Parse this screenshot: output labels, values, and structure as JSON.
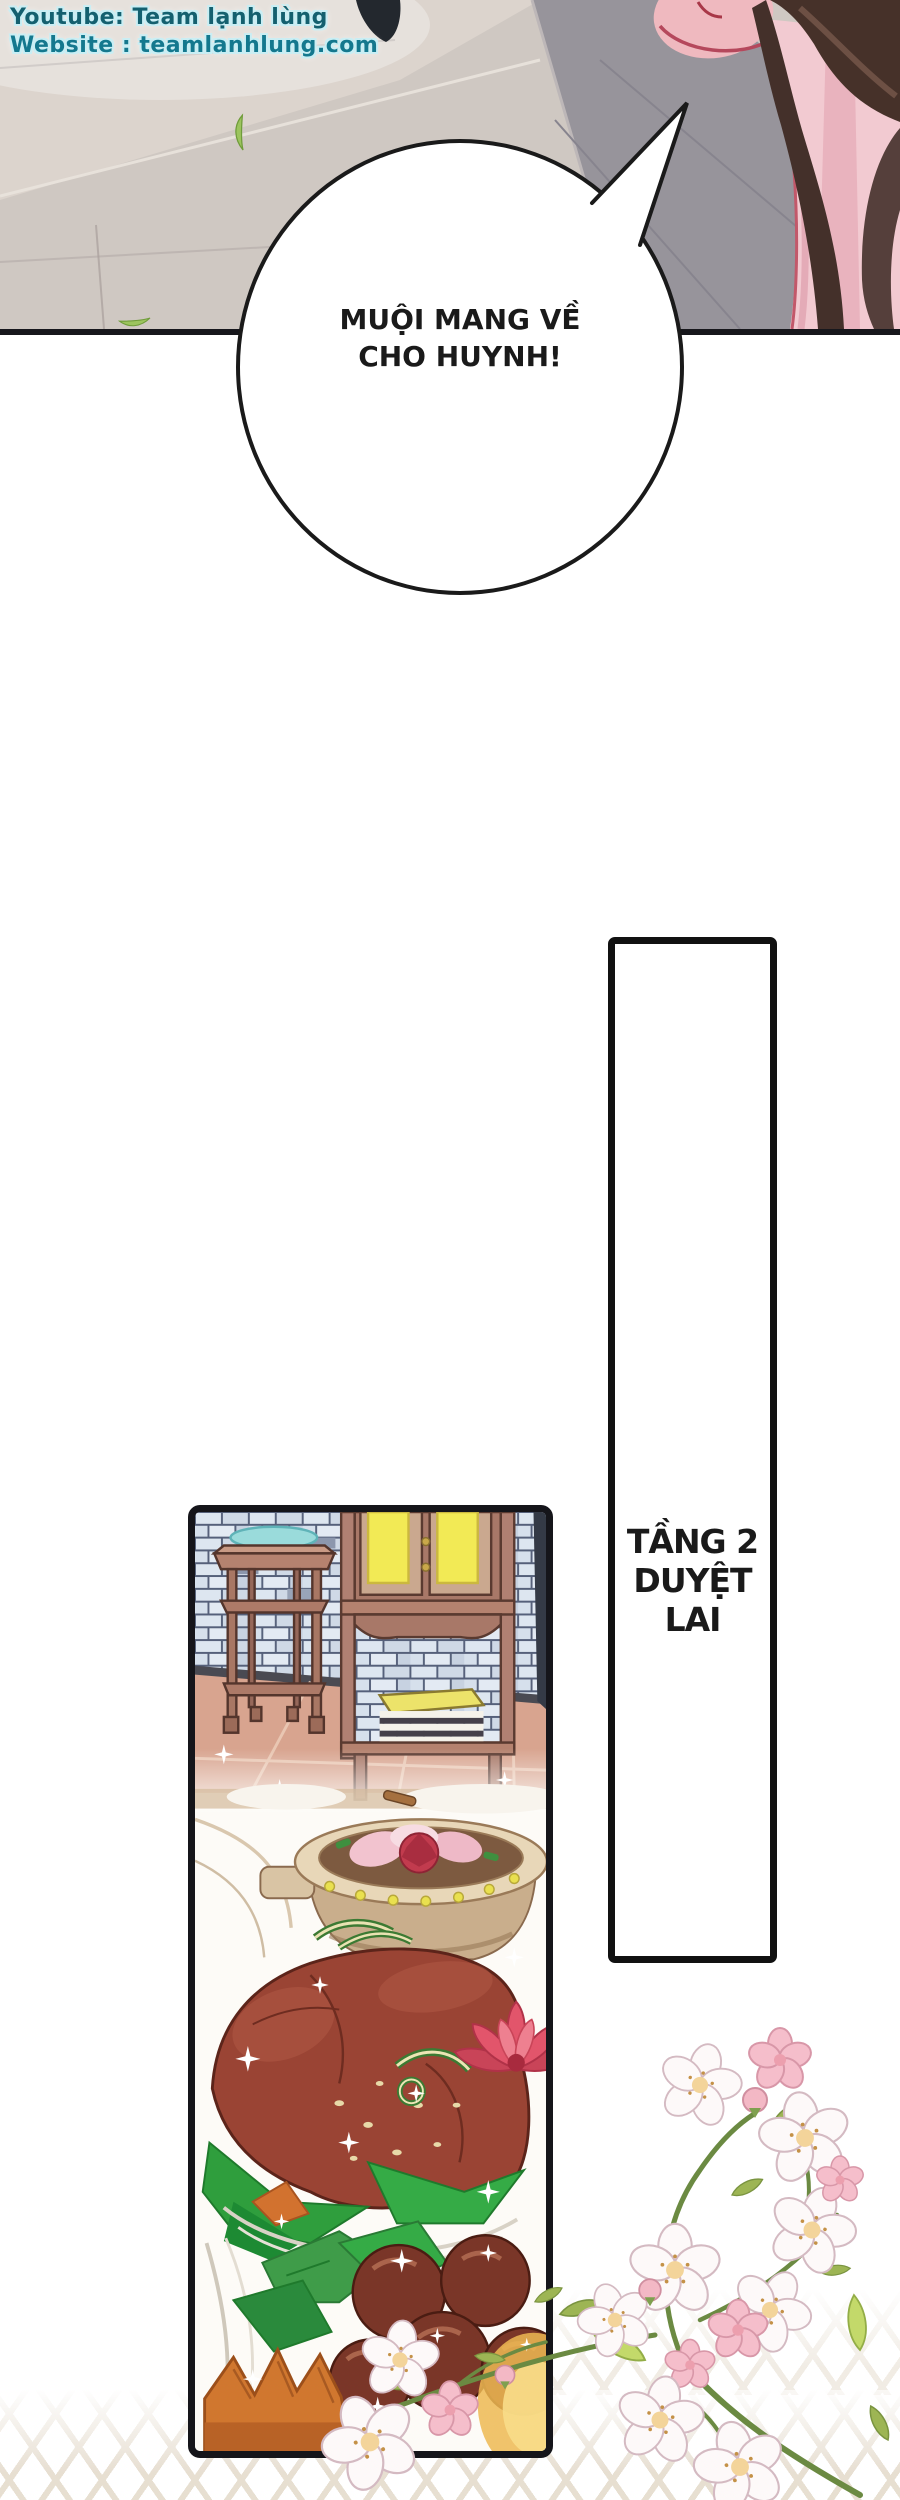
{
  "page": {
    "width": 900,
    "height": 2500,
    "background": "#ffffff"
  },
  "watermark": {
    "line1": "Youtube: Team lạnh lùng",
    "line2": "Website : teamlanhlung.com",
    "text_color": "#14606f",
    "outline_color": "#c9eef4"
  },
  "speech_bubble": {
    "lines": [
      "MUỘI MANG VỀ",
      "CHO HUYNH!"
    ],
    "text_color": "#1a1a1a",
    "border_color": "#1a1a1a",
    "fill": "#ffffff"
  },
  "caption_box": {
    "lines": [
      "TẦNG 2",
      "DUYỆT",
      "LAI"
    ],
    "text_color": "#1a1a1a",
    "border_color": "#111111",
    "fill": "#ffffff"
  },
  "colors": {
    "pavement_light": "#cfc8c2",
    "pavement_dark_band": "#97949b",
    "leaf_green": "#9cc45e",
    "hair_brown": "#463129",
    "robe_pink": "#f2cad1",
    "robe_trim_red": "#c2586a",
    "panel_border": "#15151a",
    "brick_blue": "#dde6f0",
    "wood_brown": "#b5826f",
    "cabinet_window_yellow": "#f2ea55",
    "floor_pink": "#d8a48f",
    "meat_red_brown": "#9a4434",
    "lettuce_green": "#2f9e3d",
    "lotus_pink_red": "#e2556b",
    "chestnut_brown": "#7a3628",
    "carved_bowl_orange": "#d0772f",
    "blossom_white": "#fdf9f9",
    "blossom_pink": "#f5becb",
    "stem_green": "#6b8a42",
    "lattice_beige": "#d8cab4"
  }
}
